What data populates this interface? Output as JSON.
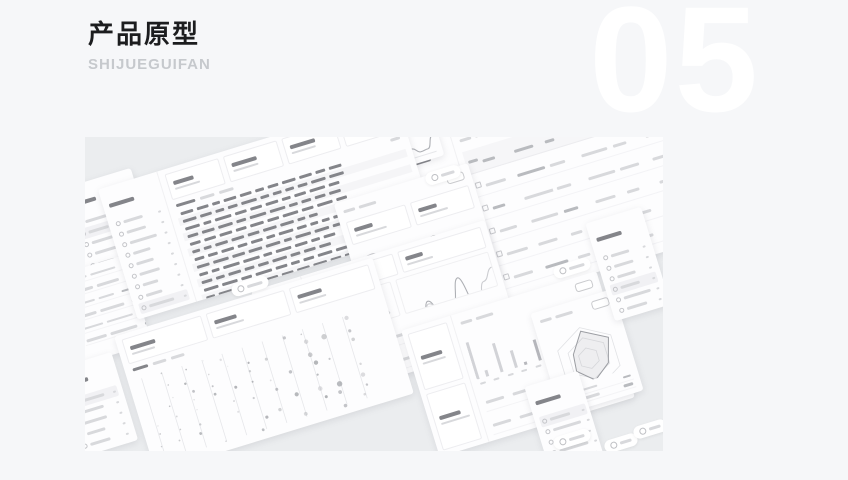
{
  "header": {
    "title": "产品原型",
    "subtitle": "SHIJUEGUIFAN",
    "section_number": "05"
  },
  "colors": {
    "page_bg": "#f6f7f9",
    "panel_bg": "#ebedef",
    "title_text": "#1c1d1f",
    "subtitle_text": "#c6c9cd",
    "number_text": "#ffffff",
    "card": "#fdfdfe",
    "ink_d": "#84858a",
    "ink_m": "#b9bbbf",
    "ink_l": "#d8d9dc"
  }
}
